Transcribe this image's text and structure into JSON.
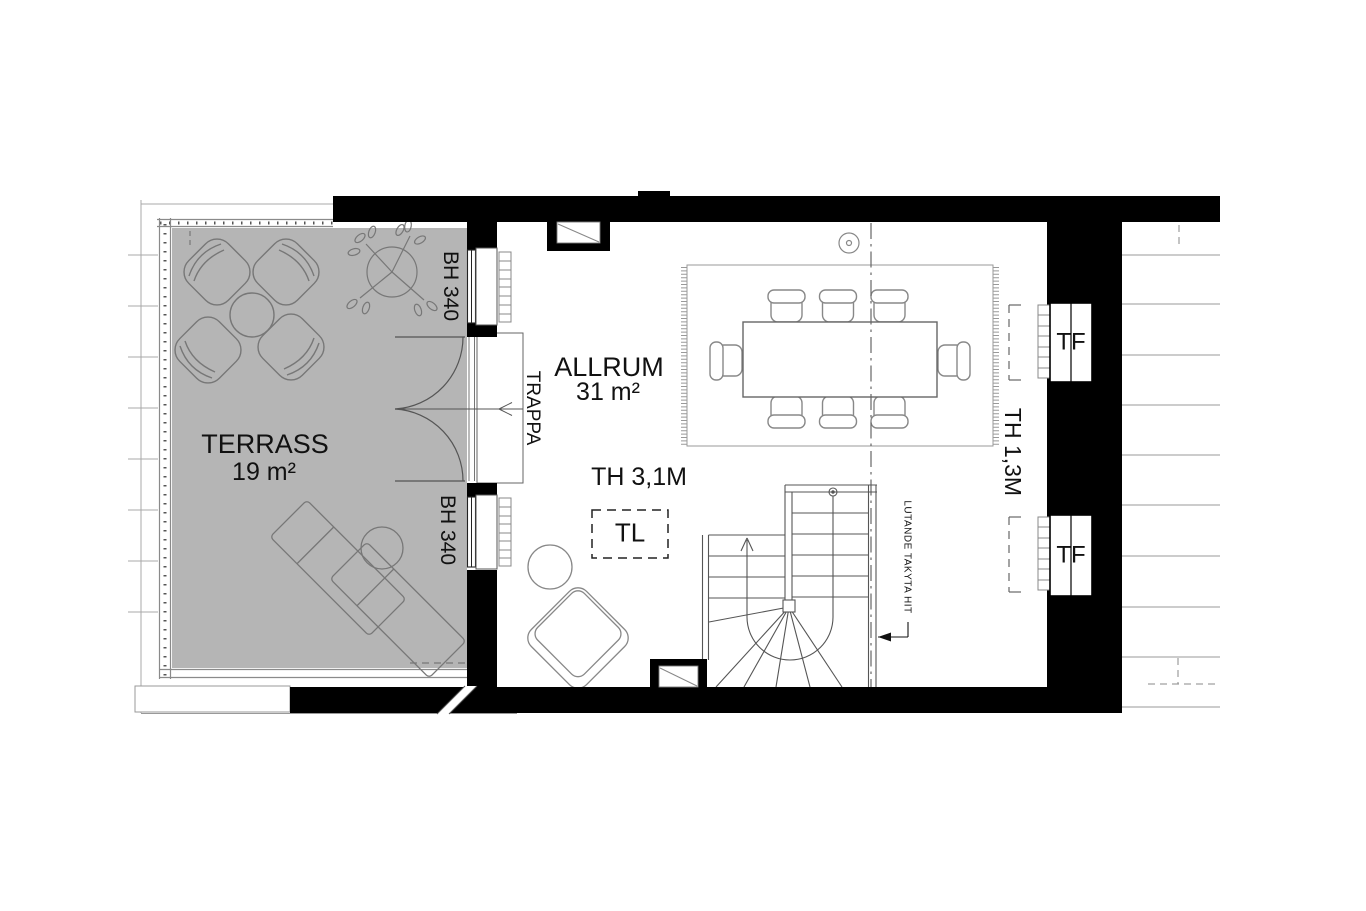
{
  "plan": {
    "type": "floorplan",
    "rooms": [
      {
        "id": "terrass",
        "label": "TERRASS",
        "area": "19 m²"
      },
      {
        "id": "allrum",
        "label": "ALLRUM",
        "area": "31 m²"
      }
    ],
    "annotations": {
      "window_height_terrace": "BH 340",
      "stair_label": "TRAPPA",
      "ceiling_height_main": "TH 3,1M",
      "floor_hatch": "TL",
      "ceiling_height_low": "TH 1,3M",
      "roof_window": "TF",
      "sloping_roof_note": "LUTANDE TAKYTA HIT"
    },
    "colors": {
      "wall": "#000000",
      "terrace_floor": "#b5b5b5",
      "furniture_line": "#777777",
      "outside_line": "#a8a8a8",
      "text": "#111111"
    }
  }
}
